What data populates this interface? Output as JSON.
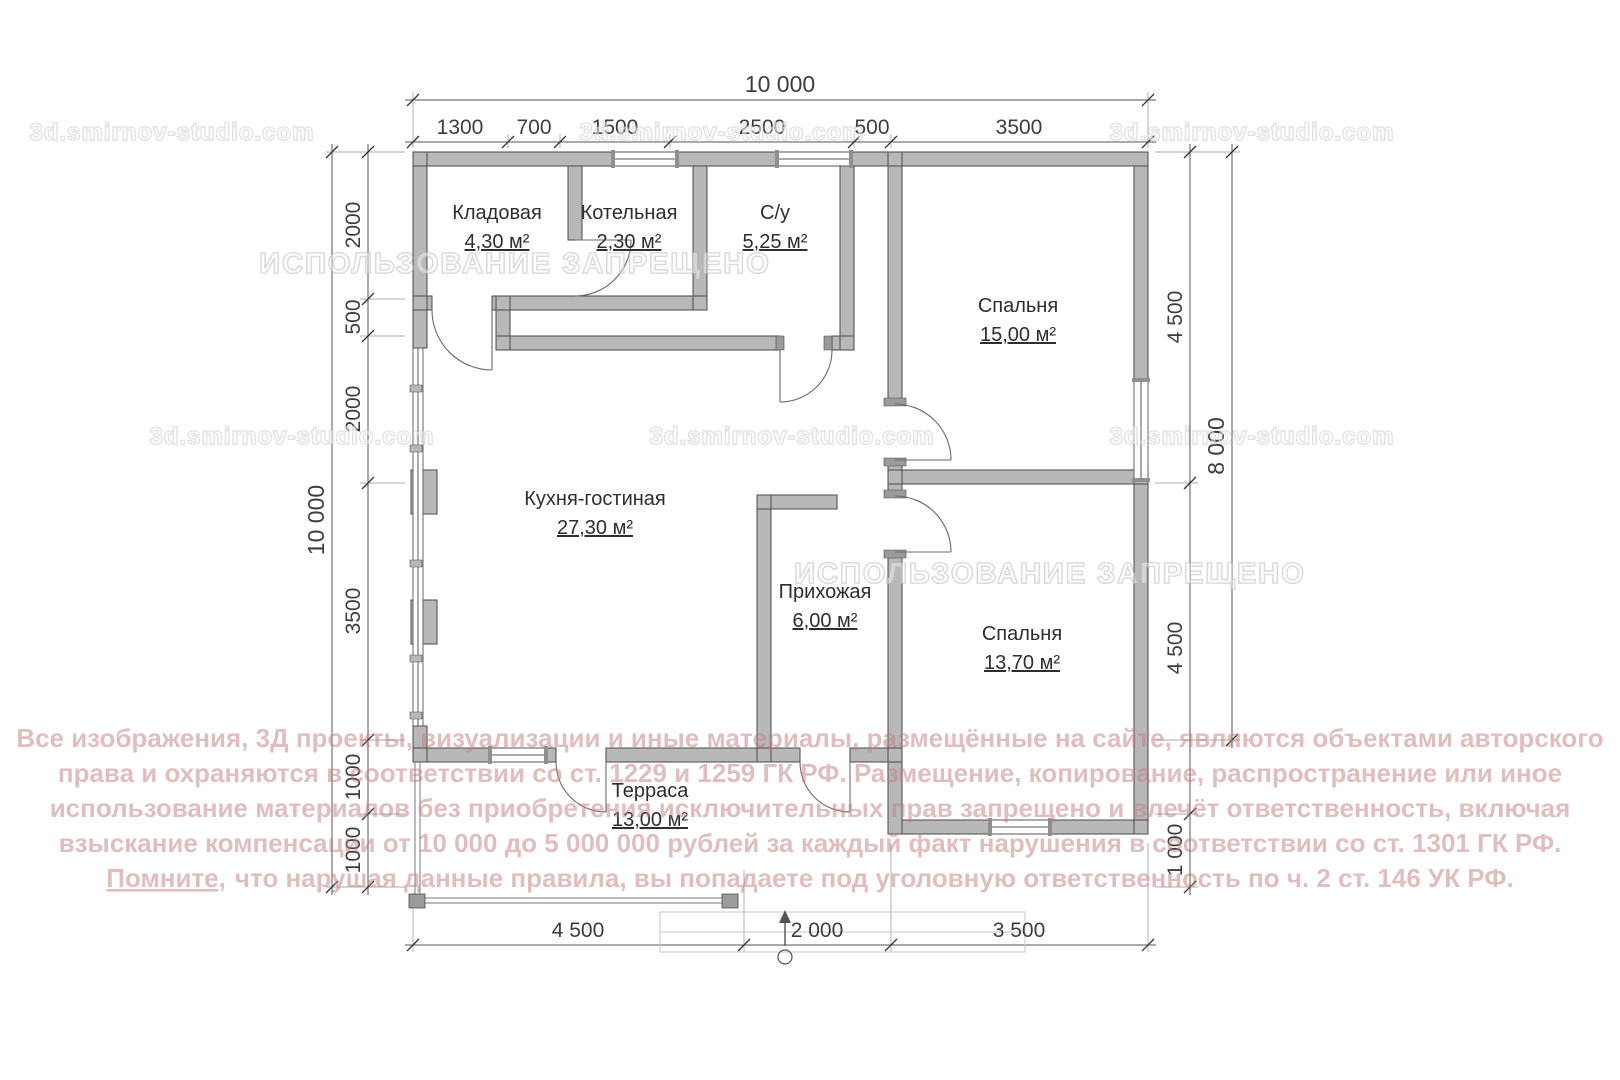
{
  "plan": {
    "rooms": [
      {
        "name": "Кладовая",
        "area": "4,30 м²"
      },
      {
        "name": "Котельная",
        "area": "2,30 м²"
      },
      {
        "name": "С/у",
        "area": "5,25 м²"
      },
      {
        "name": "Спальня",
        "area": "15,00 м²"
      },
      {
        "name": "Кухня-гостиная",
        "area": "27,30 м²"
      },
      {
        "name": "Прихожая",
        "area": "6,00 м²"
      },
      {
        "name": "Спальня",
        "area": "13,70 м²"
      },
      {
        "name": "Терраса",
        "area": "13,00 м²"
      }
    ],
    "dimensions": {
      "top_total": "10 000",
      "top_segments": [
        "1300",
        "700",
        "1500",
        "2500",
        "500",
        "3500"
      ],
      "left_total": "10 000",
      "left_segments": [
        "2000",
        "500",
        "2000",
        "3500",
        "1000",
        "1000"
      ],
      "right_inner_segments": [
        "4 500",
        "4 500",
        "1 000"
      ],
      "right_outer": "8 000",
      "bottom_segments": [
        "4 500",
        "2 000",
        "3 500"
      ]
    }
  },
  "watermarks": {
    "site": "3d.smirnov-studio.com",
    "prohibited": "ИСПОЛЬЗОВАНИЕ ЗАПРЕЩЕНО",
    "copyright_lines": [
      "Все изображения, 3Д проекты, визуализации и иные материалы, размещённые на сайте, являются объектами авторского",
      "права и охраняются в соответствии со ст. 1229 и 1259 ГК РФ. Размещение, копирование, распространение или иное",
      "использование материалов без приобретения исключительных прав запрещено и влечёт ответственность, включая",
      "взыскание компенсации от 10 000 до 5 000 000 рублей за каждый факт нарушения в соответствии со ст. 1301 ГК РФ."
    ],
    "copyright_last_underlined": "Помните,",
    "copyright_last_rest": "что нарушая данные правила, вы попадаете под уголовную ответственность по ч. 2 ст. 146 УК РФ."
  },
  "colors": {
    "wall_fill": "#b8b8b8",
    "wall_stroke": "#4a4a4a",
    "dim_line": "#555555",
    "copyright_red": "#c47e7e"
  }
}
